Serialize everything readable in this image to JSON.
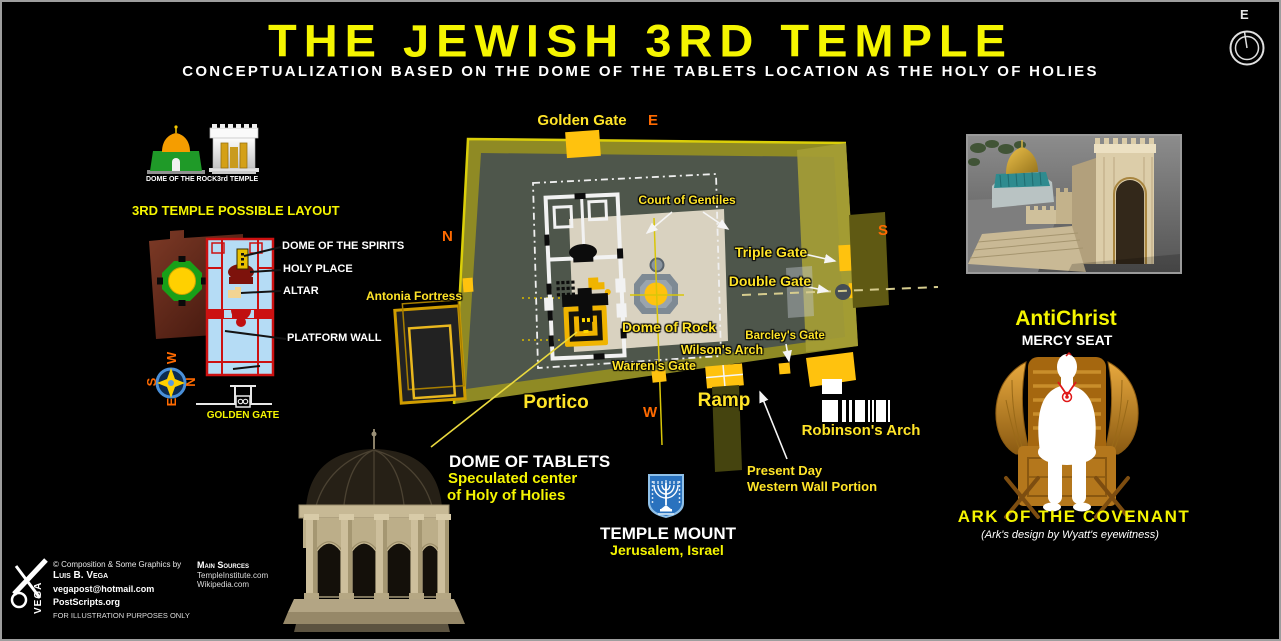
{
  "header": {
    "title": "THE JEWISH 3RD TEMPLE",
    "subtitle": "CONCEPTUALIZATION BASED ON THE DOME OF THE TABLETS LOCATION AS THE HOLY OF HOLIES",
    "compass_east": "E"
  },
  "legend": {
    "dome_of_rock": "DOME OF THE ROCK",
    "third_temple": "3rd TEMPLE"
  },
  "layout_panel": {
    "heading": "3RD TEMPLE POSSIBLE LAYOUT",
    "dome_of_spirits": "DOME OF THE SPIRITS",
    "holy_place": "HOLY PLACE",
    "altar": "ALTAR",
    "platform_wall": "PLATFORM WALL",
    "golden_gate": "GOLDEN GATE",
    "compass": {
      "w": "W",
      "s": "S",
      "n": "N",
      "e": "E"
    }
  },
  "map": {
    "golden_gate": "Golden Gate",
    "east": "E",
    "north": "N",
    "south": "S",
    "west": "W",
    "court_of_gentiles": "Court of Gentiles",
    "antonia_fortress": "Antonia Fortress",
    "triple_gate": "Triple Gate",
    "double_gate": "Double Gate",
    "dome_of_rock": "Dome of Rock",
    "barcleys_gate": "Barcley's Gate",
    "wilsons_arch": "Wilson's Arch",
    "warrens_gate": "Warren's Gate",
    "portico": "Portico",
    "ramp": "Ramp",
    "robinsons_arch": "Robinson's Arch"
  },
  "callouts": {
    "dome_of_tablets": "DOME OF TABLETS",
    "speculated_1": "Speculated center",
    "speculated_2": "of Holy of Holies",
    "temple_mount": "TEMPLE MOUNT",
    "temple_mount_sub": "Jerusalem, Israel",
    "present_day_1": "Present Day",
    "present_day_2": "Western Wall Portion"
  },
  "ark_panel": {
    "antichrist": "AntiChrist",
    "mercy_seat": "MERCY SEAT",
    "ark_title": "ARK OF THE COVENANT",
    "ark_note": "(Ark's design by Wyatt's eyewitness)"
  },
  "footer": {
    "credit_by": "© Composition & Some Graphics by",
    "credit_name": "Luis B. Vega",
    "email": "vegapost@hotmail.com",
    "website": "PostScripts.org",
    "disclaimer": "FOR ILLUSTRATION PURPOSES ONLY",
    "sources_heading": "Main Sources",
    "sources": [
      "TempleInstitute.com",
      "Wikipedia.com"
    ],
    "logo": "VEGA"
  },
  "colors": {
    "title_yellow": "#f5f500",
    "label_yellow": "#ffe428",
    "orange": "#ff6a00",
    "map_wall_olive": "#8f8a24",
    "map_interior": "#4e564b",
    "gate_gold": "#ffc20e"
  }
}
